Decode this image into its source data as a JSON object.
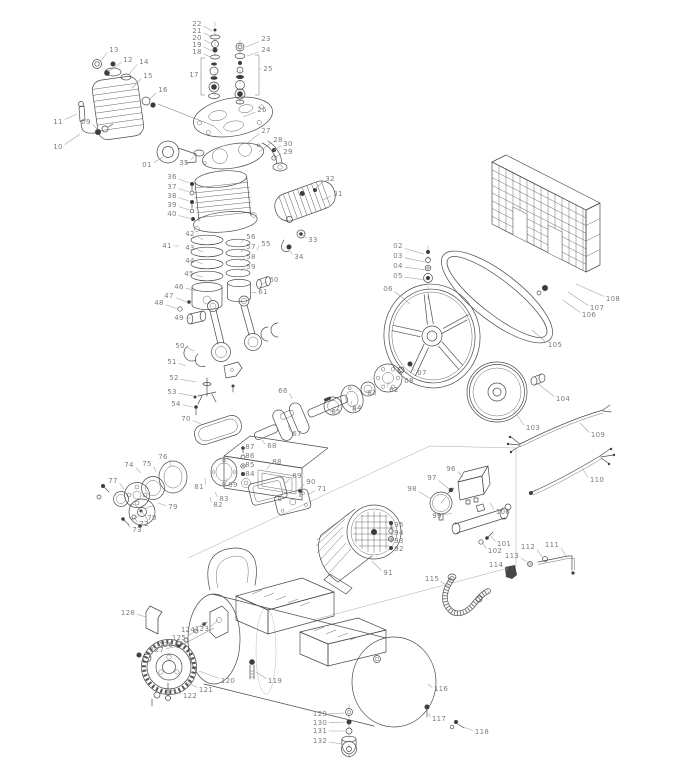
{
  "diagram": {
    "kind": "exploded-parts-diagram",
    "subject": "belt-driven air compressor with horizontal tank",
    "colors": {
      "line": "#4a4a4a",
      "label": "#7d7d7d",
      "leader": "#a0a0a0",
      "background": "#ffffff"
    }
  },
  "callouts": [
    {
      "id": "01",
      "x": 147,
      "y": 165,
      "tx": 163,
      "ty": 157
    },
    {
      "id": "02",
      "x": 398,
      "y": 246,
      "tx": 424,
      "ty": 254
    },
    {
      "id": "03",
      "x": 398,
      "y": 256,
      "tx": 425,
      "ty": 262
    },
    {
      "id": "04",
      "x": 398,
      "y": 266,
      "tx": 426,
      "ty": 270
    },
    {
      "id": "05",
      "x": 398,
      "y": 276,
      "tx": 426,
      "ty": 280
    },
    {
      "id": "06",
      "x": 388,
      "y": 289,
      "tx": 410,
      "ty": 304
    },
    {
      "id": "07",
      "x": 422,
      "y": 373,
      "tx": 411,
      "ty": 366
    },
    {
      "id": "08",
      "x": 409,
      "y": 381,
      "tx": 401,
      "ty": 373
    },
    {
      "id": "09",
      "x": 86,
      "y": 122,
      "tx": 98,
      "ty": 130
    },
    {
      "id": "10",
      "x": 58,
      "y": 147,
      "tx": 80,
      "ty": 134
    },
    {
      "id": "11",
      "x": 58,
      "y": 122,
      "tx": 77,
      "ty": 114
    },
    {
      "id": "12",
      "x": 128,
      "y": 60,
      "tx": 108,
      "ty": 72
    },
    {
      "id": "13",
      "x": 114,
      "y": 50,
      "tx": 99,
      "ty": 63
    },
    {
      "id": "14",
      "x": 144,
      "y": 62,
      "tx": 128,
      "ty": 75
    },
    {
      "id": "15",
      "x": 148,
      "y": 76,
      "tx": 132,
      "ty": 88
    },
    {
      "id": "16",
      "x": 163,
      "y": 90,
      "tx": 149,
      "ty": 100
    },
    {
      "id": "17",
      "x": 194,
      "y": 75,
      "tx": 202,
      "ty": 75
    },
    {
      "id": "18",
      "x": 197,
      "y": 52,
      "tx": 212,
      "ty": 58
    },
    {
      "id": "19",
      "x": 197,
      "y": 45,
      "tx": 212,
      "ty": 51
    },
    {
      "id": "20",
      "x": 197,
      "y": 38,
      "tx": 212,
      "ty": 44
    },
    {
      "id": "21",
      "x": 197,
      "y": 31,
      "tx": 212,
      "ty": 37
    },
    {
      "id": "22",
      "x": 197,
      "y": 24,
      "tx": 212,
      "ty": 31
    },
    {
      "id": "23",
      "x": 266,
      "y": 39,
      "tx": 246,
      "ty": 47
    },
    {
      "id": "24",
      "x": 266,
      "y": 50,
      "tx": 247,
      "ty": 56
    },
    {
      "id": "25",
      "x": 268,
      "y": 69,
      "tx": 260,
      "ty": 69
    },
    {
      "id": "26",
      "x": 262,
      "y": 110,
      "tx": 243,
      "ty": 117
    },
    {
      "id": "27",
      "x": 266,
      "y": 131,
      "tx": 248,
      "ty": 143
    },
    {
      "id": "28",
      "x": 278,
      "y": 140,
      "tx": 259,
      "ty": 152
    },
    {
      "id": "29",
      "x": 288,
      "y": 152,
      "tx": 274,
      "ty": 158
    },
    {
      "id": "30",
      "x": 288,
      "y": 144,
      "tx": 274,
      "ty": 150
    },
    {
      "id": "31",
      "x": 338,
      "y": 194,
      "tx": 323,
      "ty": 200
    },
    {
      "id": "32",
      "x": 330,
      "y": 179,
      "tx": 315,
      "ty": 189
    },
    {
      "id": "33",
      "x": 313,
      "y": 240,
      "tx": 302,
      "ty": 234
    },
    {
      "id": "34",
      "x": 299,
      "y": 257,
      "tx": 289,
      "ty": 249
    },
    {
      "id": "35",
      "x": 184,
      "y": 163,
      "tx": 196,
      "ty": 153
    },
    {
      "id": "36",
      "x": 172,
      "y": 177,
      "tx": 189,
      "ty": 183
    },
    {
      "id": "37",
      "x": 172,
      "y": 187,
      "tx": 189,
      "ty": 192
    },
    {
      "id": "38",
      "x": 172,
      "y": 196,
      "tx": 189,
      "ty": 201
    },
    {
      "id": "39",
      "x": 172,
      "y": 205,
      "tx": 189,
      "ty": 210
    },
    {
      "id": "40",
      "x": 172,
      "y": 214,
      "tx": 192,
      "ty": 219
    },
    {
      "id": "41",
      "x": 167,
      "y": 246,
      "tx": 179,
      "ty": 246
    },
    {
      "id": "42",
      "x": 190,
      "y": 234,
      "tx": 203,
      "ty": 240
    },
    {
      "id": "43",
      "x": 190,
      "y": 248,
      "tx": 203,
      "ty": 252
    },
    {
      "id": "44",
      "x": 190,
      "y": 261,
      "tx": 203,
      "ty": 264
    },
    {
      "id": "45",
      "x": 189,
      "y": 274,
      "tx": 203,
      "ty": 277
    },
    {
      "id": "46",
      "x": 179,
      "y": 287,
      "tx": 196,
      "ty": 291
    },
    {
      "id": "47",
      "x": 169,
      "y": 296,
      "tx": 187,
      "ty": 302
    },
    {
      "id": "48",
      "x": 159,
      "y": 303,
      "tx": 178,
      "ty": 309
    },
    {
      "id": "49",
      "x": 179,
      "y": 318,
      "tx": 191,
      "ty": 318
    },
    {
      "id": "50",
      "x": 180,
      "y": 346,
      "tx": 194,
      "ty": 351
    },
    {
      "id": "51",
      "x": 172,
      "y": 362,
      "tx": 186,
      "ty": 366
    },
    {
      "id": "52",
      "x": 174,
      "y": 378,
      "tx": 196,
      "ty": 382
    },
    {
      "id": "53",
      "x": 172,
      "y": 392,
      "tx": 193,
      "ty": 396
    },
    {
      "id": "54",
      "x": 176,
      "y": 404,
      "tx": 193,
      "ty": 407
    },
    {
      "id": "55",
      "x": 266,
      "y": 244,
      "tx": 257,
      "ty": 250
    },
    {
      "id": "56",
      "x": 251,
      "y": 237,
      "tx": 241,
      "ty": 243
    },
    {
      "id": "57",
      "x": 251,
      "y": 247,
      "tx": 241,
      "ty": 252
    },
    {
      "id": "58",
      "x": 251,
      "y": 257,
      "tx": 241,
      "ty": 261
    },
    {
      "id": "59",
      "x": 251,
      "y": 267,
      "tx": 241,
      "ty": 271
    },
    {
      "id": "60",
      "x": 274,
      "y": 280,
      "tx": 261,
      "ty": 285
    },
    {
      "id": "61",
      "x": 263,
      "y": 292,
      "tx": 250,
      "ty": 293
    },
    {
      "id": "62",
      "x": 394,
      "y": 390,
      "tx": 389,
      "ty": 381
    },
    {
      "id": "63",
      "x": 372,
      "y": 393,
      "tx": 368,
      "ty": 390
    },
    {
      "id": "64",
      "x": 357,
      "y": 408,
      "tx": 352,
      "ty": 401
    },
    {
      "id": "65",
      "x": 336,
      "y": 412,
      "tx": 333,
      "ty": 407
    },
    {
      "id": "66",
      "x": 283,
      "y": 391,
      "tx": 292,
      "ty": 399
    },
    {
      "id": "67",
      "x": 297,
      "y": 434,
      "tx": 288,
      "ty": 425
    },
    {
      "id": "68",
      "x": 272,
      "y": 446,
      "tx": 262,
      "ty": 440
    },
    {
      "id": "69",
      "x": 233,
      "y": 485,
      "tx": 227,
      "ty": 478
    },
    {
      "id": "70",
      "x": 186,
      "y": 419,
      "tx": 201,
      "ty": 424
    },
    {
      "id": "71",
      "x": 322,
      "y": 489,
      "tx": 307,
      "ty": 495
    },
    {
      "id": "72",
      "x": 144,
      "y": 524,
      "tx": 134,
      "ty": 517
    },
    {
      "id": "73",
      "x": 137,
      "y": 530,
      "tx": 126,
      "ty": 522
    },
    {
      "id": "74",
      "x": 129,
      "y": 465,
      "tx": 141,
      "ty": 473
    },
    {
      "id": "75",
      "x": 147,
      "y": 464,
      "tx": 156,
      "ty": 472
    },
    {
      "id": "76",
      "x": 163,
      "y": 457,
      "tx": 171,
      "ty": 467
    },
    {
      "id": "77",
      "x": 113,
      "y": 481,
      "tx": 124,
      "ty": 489
    },
    {
      "id": "78",
      "x": 152,
      "y": 518,
      "tx": 141,
      "ty": 511
    },
    {
      "id": "79",
      "x": 173,
      "y": 507,
      "tx": 158,
      "ty": 503
    },
    {
      "id": "81",
      "x": 199,
      "y": 487,
      "tx": 205,
      "ty": 478
    },
    {
      "id": "82",
      "x": 218,
      "y": 505,
      "tx": 210,
      "ty": 497
    },
    {
      "id": "83",
      "x": 224,
      "y": 499,
      "tx": 215,
      "ty": 492
    },
    {
      "id": "84",
      "x": 250,
      "y": 474,
      "tx": 243,
      "ty": 474
    },
    {
      "id": "85",
      "x": 250,
      "y": 465,
      "tx": 243,
      "ty": 465
    },
    {
      "id": "86",
      "x": 250,
      "y": 456,
      "tx": 243,
      "ty": 456
    },
    {
      "id": "87",
      "x": 250,
      "y": 447,
      "tx": 243,
      "ty": 448
    },
    {
      "id": "88",
      "x": 277,
      "y": 462,
      "tx": 266,
      "ty": 470
    },
    {
      "id": "89",
      "x": 297,
      "y": 476,
      "tx": 284,
      "ty": 484
    },
    {
      "id": "90",
      "x": 311,
      "y": 482,
      "tx": 298,
      "ty": 490
    },
    {
      "id": "91",
      "x": 388,
      "y": 573,
      "tx": 372,
      "ty": 561
    },
    {
      "id": "92",
      "x": 399,
      "y": 549,
      "tx": 392,
      "ty": 549
    },
    {
      "id": "93",
      "x": 399,
      "y": 541,
      "tx": 392,
      "ty": 541
    },
    {
      "id": "94",
      "x": 399,
      "y": 533,
      "tx": 392,
      "ty": 533
    },
    {
      "id": "95",
      "x": 399,
      "y": 525,
      "tx": 392,
      "ty": 525
    },
    {
      "id": "96",
      "x": 451,
      "y": 469,
      "tx": 463,
      "ty": 477
    },
    {
      "id": "97",
      "x": 432,
      "y": 478,
      "tx": 449,
      "ty": 489
    },
    {
      "id": "98",
      "x": 412,
      "y": 489,
      "tx": 431,
      "ty": 499
    },
    {
      "id": "99",
      "x": 437,
      "y": 516,
      "tx": 452,
      "ty": 513
    },
    {
      "id": "100",
      "x": 503,
      "y": 512,
      "tx": 490,
      "ty": 503
    },
    {
      "id": "101",
      "x": 504,
      "y": 544,
      "tx": 491,
      "ty": 536
    },
    {
      "id": "102",
      "x": 495,
      "y": 551,
      "tx": 482,
      "ty": 542
    },
    {
      "id": "103",
      "x": 533,
      "y": 428,
      "tx": 513,
      "ty": 409
    },
    {
      "id": "104",
      "x": 563,
      "y": 399,
      "tx": 537,
      "ty": 383
    },
    {
      "id": "105",
      "x": 555,
      "y": 345,
      "tx": 532,
      "ty": 330
    },
    {
      "id": "106",
      "x": 589,
      "y": 315,
      "tx": 563,
      "ty": 300
    },
    {
      "id": "107",
      "x": 597,
      "y": 308,
      "tx": 568,
      "ty": 292
    },
    {
      "id": "108",
      "x": 613,
      "y": 299,
      "tx": 576,
      "ty": 284
    },
    {
      "id": "109",
      "x": 598,
      "y": 435,
      "tx": 580,
      "ty": 423
    },
    {
      "id": "110",
      "x": 597,
      "y": 480,
      "tx": 582,
      "ty": 468
    },
    {
      "id": "111",
      "x": 552,
      "y": 545,
      "tx": 566,
      "ty": 556
    },
    {
      "id": "112",
      "x": 528,
      "y": 547,
      "tx": 542,
      "ty": 557
    },
    {
      "id": "113",
      "x": 512,
      "y": 556,
      "tx": 527,
      "ty": 562
    },
    {
      "id": "114",
      "x": 496,
      "y": 565,
      "tx": 508,
      "ty": 570
    },
    {
      "id": "115",
      "x": 432,
      "y": 579,
      "tx": 449,
      "ty": 587
    },
    {
      "id": "116",
      "x": 441,
      "y": 689,
      "tx": 428,
      "ty": 684
    },
    {
      "id": "117",
      "x": 439,
      "y": 719,
      "tx": 429,
      "ty": 713
    },
    {
      "id": "118",
      "x": 482,
      "y": 732,
      "tx": 463,
      "ty": 727
    },
    {
      "id": "119",
      "x": 275,
      "y": 681,
      "tx": 256,
      "ty": 672
    },
    {
      "id": "120",
      "x": 228,
      "y": 681,
      "tx": 199,
      "ty": 671
    },
    {
      "id": "121",
      "x": 206,
      "y": 690,
      "tx": 184,
      "ty": 681
    },
    {
      "id": "122",
      "x": 190,
      "y": 696,
      "tx": 169,
      "ty": 689
    },
    {
      "id": "123",
      "x": 202,
      "y": 629,
      "tx": 218,
      "ty": 620
    },
    {
      "id": "124",
      "x": 188,
      "y": 630,
      "tx": 204,
      "ty": 623
    },
    {
      "id": "125",
      "x": 179,
      "y": 638,
      "tx": 196,
      "ty": 631
    },
    {
      "id": "126",
      "x": 166,
      "y": 645,
      "tx": 186,
      "ty": 640
    },
    {
      "id": "127",
      "x": 157,
      "y": 650,
      "tx": 178,
      "ty": 646
    },
    {
      "id": "128",
      "x": 128,
      "y": 613,
      "tx": 146,
      "ty": 617
    },
    {
      "id": "129",
      "x": 320,
      "y": 714,
      "tx": 344,
      "ty": 713
    },
    {
      "id": "130",
      "x": 320,
      "y": 723,
      "tx": 345,
      "ty": 722
    },
    {
      "id": "131",
      "x": 320,
      "y": 731,
      "tx": 345,
      "ty": 731
    },
    {
      "id": "132",
      "x": 320,
      "y": 741,
      "tx": 342,
      "ty": 744
    }
  ]
}
